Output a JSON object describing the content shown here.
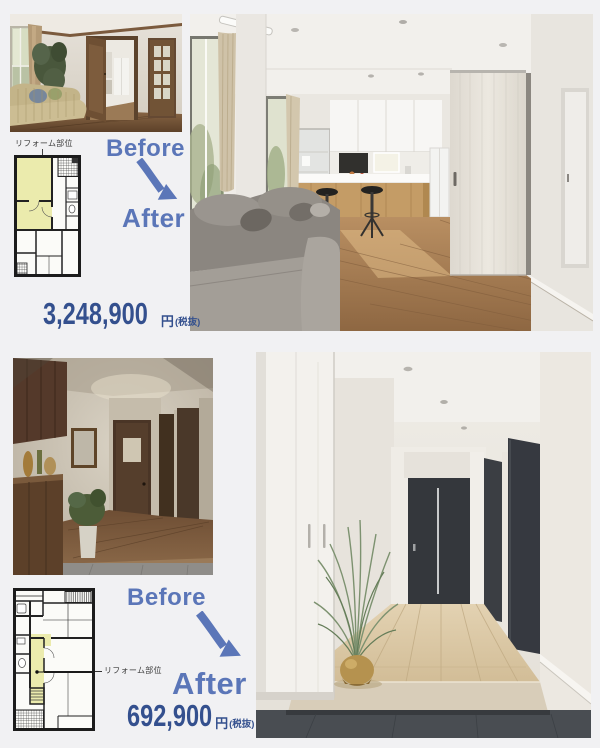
{
  "page": {
    "background": "#f1f1f3"
  },
  "colors": {
    "accent_blue": "#5b76b8",
    "price_navy": "#34508e",
    "plan_highlight": "#ebebad"
  },
  "sections": [
    {
      "name": "living-dining-kitchen",
      "before_label": "Before",
      "after_label": "After",
      "plan_label": "リフォーム部位",
      "price": {
        "amount": "3,248,900",
        "currency": "円",
        "tax_note": "(税抜)"
      }
    },
    {
      "name": "entrance-hallway",
      "before_label": "Before",
      "after_label": "After",
      "plan_label": "リフォーム部位",
      "price": {
        "amount": "692,900",
        "currency": "円",
        "tax_note": "(税抜)"
      }
    }
  ],
  "icons": [
    {
      "name": "curved-arrow-down-right-icon",
      "color": "#5b76b8"
    }
  ]
}
